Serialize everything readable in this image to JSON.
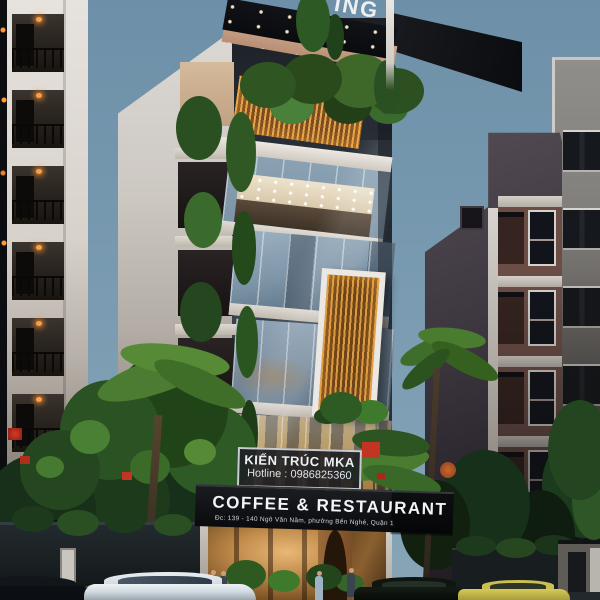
{
  "signs": {
    "top_banner_partial": "ING",
    "studio_plate": {
      "name": "KIẾN TRÚC MKA",
      "hotline": "Hotline : 0986825360"
    },
    "storefront": {
      "title": "COFFEE & RESTAURANT",
      "address": "Đc: 139 - 140 Ngô Văn Năm, phường Bến Nghé, Quận 1"
    }
  },
  "palette": {
    "sky_dusk": "#7394ab",
    "sign_band_black": "#0e0f12",
    "sign_text_white": "#f2f4f6",
    "wood_slat_warm": "#d99c3f",
    "glass_facade": "#8fa6b8",
    "white_wall": "#d6d1cc",
    "foliage_dark": "#1d3a1c",
    "foliage_light": "#568a36",
    "entrance_glow": "#d9a25e",
    "balcony_lamp_orange": "#ff9a3a",
    "flower_red": "#c23522",
    "taxi_yellow": "#c9bd4a"
  }
}
